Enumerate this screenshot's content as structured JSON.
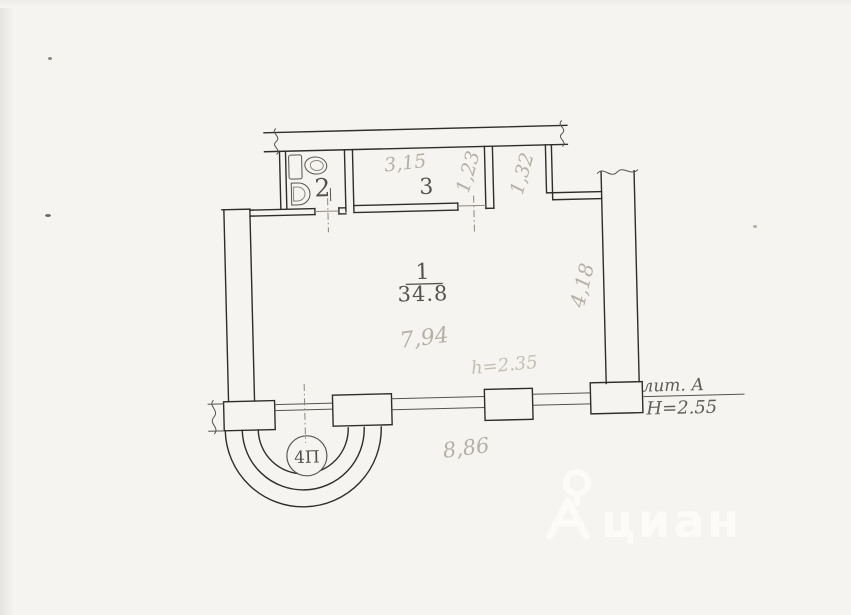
{
  "colors": {
    "paper": "#f6f4f0",
    "ink_line": "#2f2d2b",
    "printed_label": "#55524e",
    "pencil_dimension": "#b5b0a7",
    "watermark": "#fcfbf8"
  },
  "plan": {
    "rooms": {
      "room1": {
        "number": "1",
        "area": "34.8"
      },
      "room2": {
        "number": "2"
      },
      "room3": {
        "number": "3"
      }
    },
    "dims": {
      "room3_width": "3,15",
      "room3_depth": "1,23",
      "entry_gap": "1,32",
      "right_side": "4,18",
      "room1_width": "7,94",
      "ceiling_height": "h=2.35",
      "facade_width": "8,86"
    },
    "stamp": {
      "bay_mark": "4П",
      "liter": "лит. А",
      "building_height": "Н=2.55"
    }
  },
  "watermark": {
    "text": "циан"
  }
}
